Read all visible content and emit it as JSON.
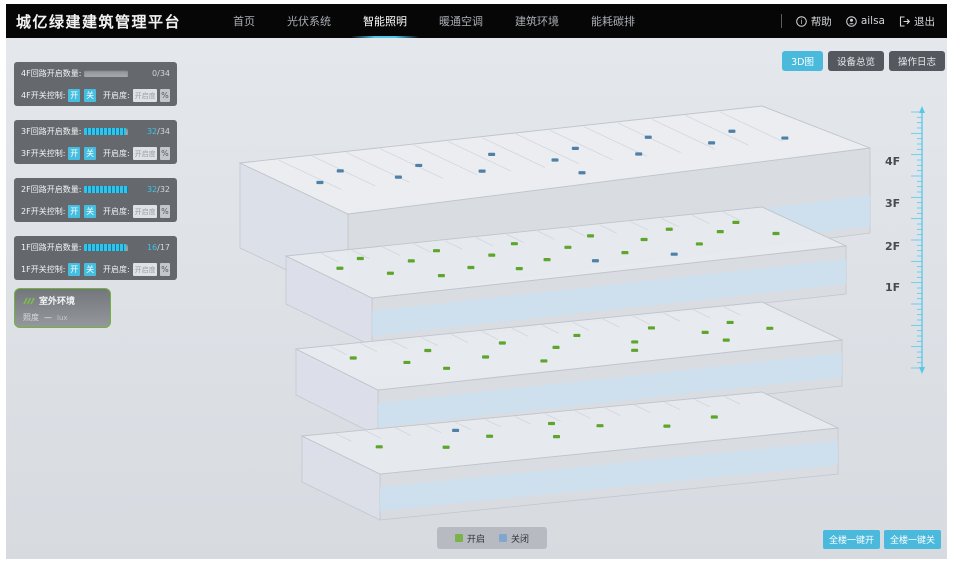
{
  "header": {
    "title": "城亿绿建建筑管理平台",
    "nav": [
      {
        "label": "首页"
      },
      {
        "label": "光伏系统"
      },
      {
        "label": "智能照明"
      },
      {
        "label": "暖通空调"
      },
      {
        "label": "建筑环境"
      },
      {
        "label": "能耗碳排"
      }
    ],
    "help_label": "帮助",
    "user_name": "ailsa",
    "logout_label": "退出"
  },
  "toolbar": {
    "view_3d": "3D图",
    "device_overview": "设备总览",
    "operation_log": "操作日志"
  },
  "floor_panels": [
    {
      "circuit_label": "4F回路开启数量:",
      "count": "0",
      "total": "/34",
      "progress_pct": 0,
      "count_color": "#cfd3d8",
      "switch_label": "4F开关控制:",
      "on_label": "开",
      "off_label": "关",
      "dim_label": "开启度:",
      "dim_placeholder": "开启度",
      "percent_label": "%"
    },
    {
      "circuit_label": "3F回路开启数量:",
      "count": "32",
      "total": "/34",
      "progress_pct": 94,
      "count_color": "#3bc4e9",
      "switch_label": "3F开关控制:",
      "on_label": "开",
      "off_label": "关",
      "dim_label": "开启度:",
      "dim_placeholder": "开启度",
      "percent_label": "%"
    },
    {
      "circuit_label": "2F回路开启数量:",
      "count": "32",
      "total": "/32",
      "progress_pct": 100,
      "count_color": "#3bc4e9",
      "switch_label": "2F开关控制:",
      "on_label": "开",
      "off_label": "关",
      "dim_label": "开启度:",
      "dim_placeholder": "开启度",
      "percent_label": "%"
    },
    {
      "circuit_label": "1F回路开启数量:",
      "count": "16",
      "total": "/17",
      "progress_pct": 94,
      "count_color": "#3bc4e9",
      "switch_label": "1F开关控制:",
      "on_label": "开",
      "off_label": "关",
      "dim_label": "开启度:",
      "dim_placeholder": "开启度",
      "percent_label": "%"
    }
  ],
  "outdoor": {
    "title": "室外环境",
    "metric_label": "照度",
    "metric_value": "—",
    "metric_unit": "lux"
  },
  "floor_labels": [
    "4F",
    "3F",
    "2F",
    "1F"
  ],
  "legend": {
    "on_label": "开启",
    "off_label": "关闭",
    "on_color": "#7cb24c",
    "off_color": "#7fa7cf"
  },
  "actions": {
    "all_on": "全楼一键开",
    "all_off": "全楼一键关"
  },
  "building": {
    "on_color": "#5da52b",
    "off_color": "#4f81a8",
    "floors": [
      {
        "name": "4F",
        "lights": [
          [
            0.06,
            0.45,
            0
          ],
          [
            0.13,
            0.3,
            0
          ],
          [
            0.2,
            0.5,
            0
          ],
          [
            0.27,
            0.35,
            0
          ],
          [
            0.35,
            0.55,
            0
          ],
          [
            0.42,
            0.3,
            0
          ],
          [
            0.5,
            0.5,
            0
          ],
          [
            0.57,
            0.35,
            0
          ],
          [
            0.65,
            0.55,
            0
          ],
          [
            0.72,
            0.3,
            0
          ],
          [
            0.8,
            0.5,
            0
          ],
          [
            0.87,
            0.35,
            0
          ],
          [
            0.93,
            0.55,
            0
          ],
          [
            0.5,
            0.75,
            0
          ]
        ]
      },
      {
        "name": "3F",
        "lights": [
          [
            0.05,
            0.35,
            1
          ],
          [
            0.12,
            0.2,
            1
          ],
          [
            0.12,
            0.55,
            1
          ],
          [
            0.2,
            0.35,
            1
          ],
          [
            0.28,
            0.2,
            1
          ],
          [
            0.28,
            0.6,
            1
          ],
          [
            0.36,
            0.4,
            1
          ],
          [
            0.44,
            0.22,
            1
          ],
          [
            0.44,
            0.6,
            1
          ],
          [
            0.52,
            0.4,
            1
          ],
          [
            0.6,
            0.22,
            1
          ],
          [
            0.6,
            0.62,
            1
          ],
          [
            0.68,
            0.4,
            1
          ],
          [
            0.76,
            0.25,
            1
          ],
          [
            0.76,
            0.6,
            1
          ],
          [
            0.84,
            0.4,
            1
          ],
          [
            0.9,
            0.25,
            1
          ],
          [
            0.93,
            0.55,
            1
          ],
          [
            0.2,
            0.7,
            1
          ],
          [
            0.36,
            0.72,
            1
          ],
          [
            0.52,
            0.72,
            0
          ],
          [
            0.68,
            0.75,
            0
          ]
        ]
      },
      {
        "name": "2F",
        "lights": [
          [
            0.07,
            0.3,
            1
          ],
          [
            0.15,
            0.5,
            1
          ],
          [
            0.23,
            0.3,
            1
          ],
          [
            0.31,
            0.55,
            1
          ],
          [
            0.39,
            0.3,
            1
          ],
          [
            0.47,
            0.5,
            1
          ],
          [
            0.55,
            0.3,
            1
          ],
          [
            0.63,
            0.55,
            1
          ],
          [
            0.71,
            0.3,
            1
          ],
          [
            0.79,
            0.5,
            1
          ],
          [
            0.87,
            0.35,
            1
          ],
          [
            0.92,
            0.55,
            1
          ],
          [
            0.2,
            0.7,
            1
          ],
          [
            0.4,
            0.75,
            1
          ],
          [
            0.6,
            0.72,
            1
          ],
          [
            0.8,
            0.7,
            1
          ]
        ]
      },
      {
        "name": "1F",
        "lights": [
          [
            0.1,
            0.4,
            1
          ],
          [
            0.22,
            0.55,
            1
          ],
          [
            0.34,
            0.4,
            1
          ],
          [
            0.46,
            0.55,
            1
          ],
          [
            0.58,
            0.4,
            1
          ],
          [
            0.7,
            0.55,
            1
          ],
          [
            0.82,
            0.45,
            1
          ],
          [
            0.5,
            0.25,
            1
          ],
          [
            0.3,
            0.2,
            0
          ]
        ]
      }
    ]
  }
}
